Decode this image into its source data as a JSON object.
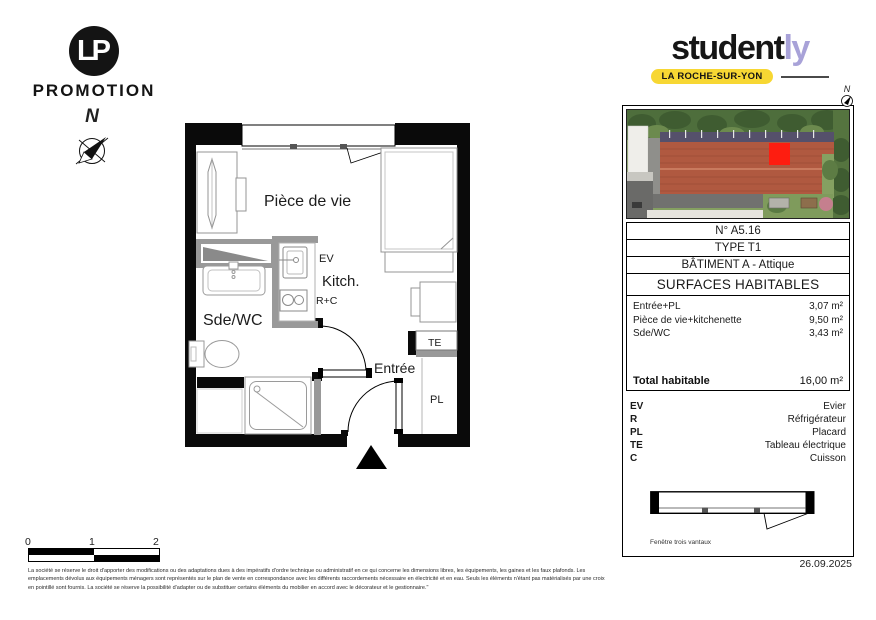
{
  "branding": {
    "lp": {
      "monogram": "LP",
      "name": "PROMOTION"
    },
    "studently": {
      "word_black": "student",
      "word_accent": "ly",
      "city": "LA ROCHE-SUR-YON",
      "accent_color": "#a8a2d8",
      "badge_color": "#f7d733"
    }
  },
  "compass": {
    "label": "N"
  },
  "photo": {
    "north_label": "N",
    "marker_color": "#fe1d10"
  },
  "unit": {
    "number": "N° A5.16",
    "type": "TYPE T1",
    "building": "BÂTIMENT A - Attique",
    "surfaces_title": "SURFACES HABITABLES",
    "rooms": [
      {
        "name": "Entrée+PL",
        "area": "3,07 m²"
      },
      {
        "name": "Pièce de vie+kitchenette",
        "area": "9,50 m²"
      },
      {
        "name": "Sde/WC",
        "area": "3,43 m²"
      }
    ],
    "total_label": "Total habitable",
    "total_area": "16,00 m²"
  },
  "legend": {
    "entries": [
      {
        "abbr": "EV",
        "label": "Evier"
      },
      {
        "abbr": "R",
        "label": "Réfrigérateur"
      },
      {
        "abbr": "PL",
        "label": "Placard"
      },
      {
        "abbr": "TE",
        "label": "Tableau électrique"
      },
      {
        "abbr": "C",
        "label": "Cuisson"
      }
    ],
    "window_caption": "Fenêtre trois vantaux"
  },
  "plan": {
    "labels": {
      "living": "Pièce de vie",
      "kitchen": "Kitch.",
      "sink": "EV",
      "hob": "R+C",
      "bathroom": "Sde/WC",
      "entrance": "Entrée",
      "electrical_panel": "TE",
      "closet": "PL"
    }
  },
  "scale_bar": {
    "ticks": [
      "0",
      "1",
      "2"
    ]
  },
  "footer": {
    "disclaimer": "La société se réserve le droit d'apporter des modifications ou des adaptations dues à des impératifs d'ordre technique ou administratif en ce qui concerne les dimensions libres, les équipements, les gaines et les faux plafonds. Les emplacements dévolus aux équipements ménagers sont représentés sur le plan de vente en correspondance avec les différents raccordements nécessaire en électricité et en eau. Seuls les éléments n'étant pas matérialisés par une croix en pointillé sont fournis. La société se réserve la possibilité d'adapter ou de substituer certains éléments du mobilier en accord avec le décorateur et le gestionnaire.\"",
    "date": "26.09.2025"
  }
}
